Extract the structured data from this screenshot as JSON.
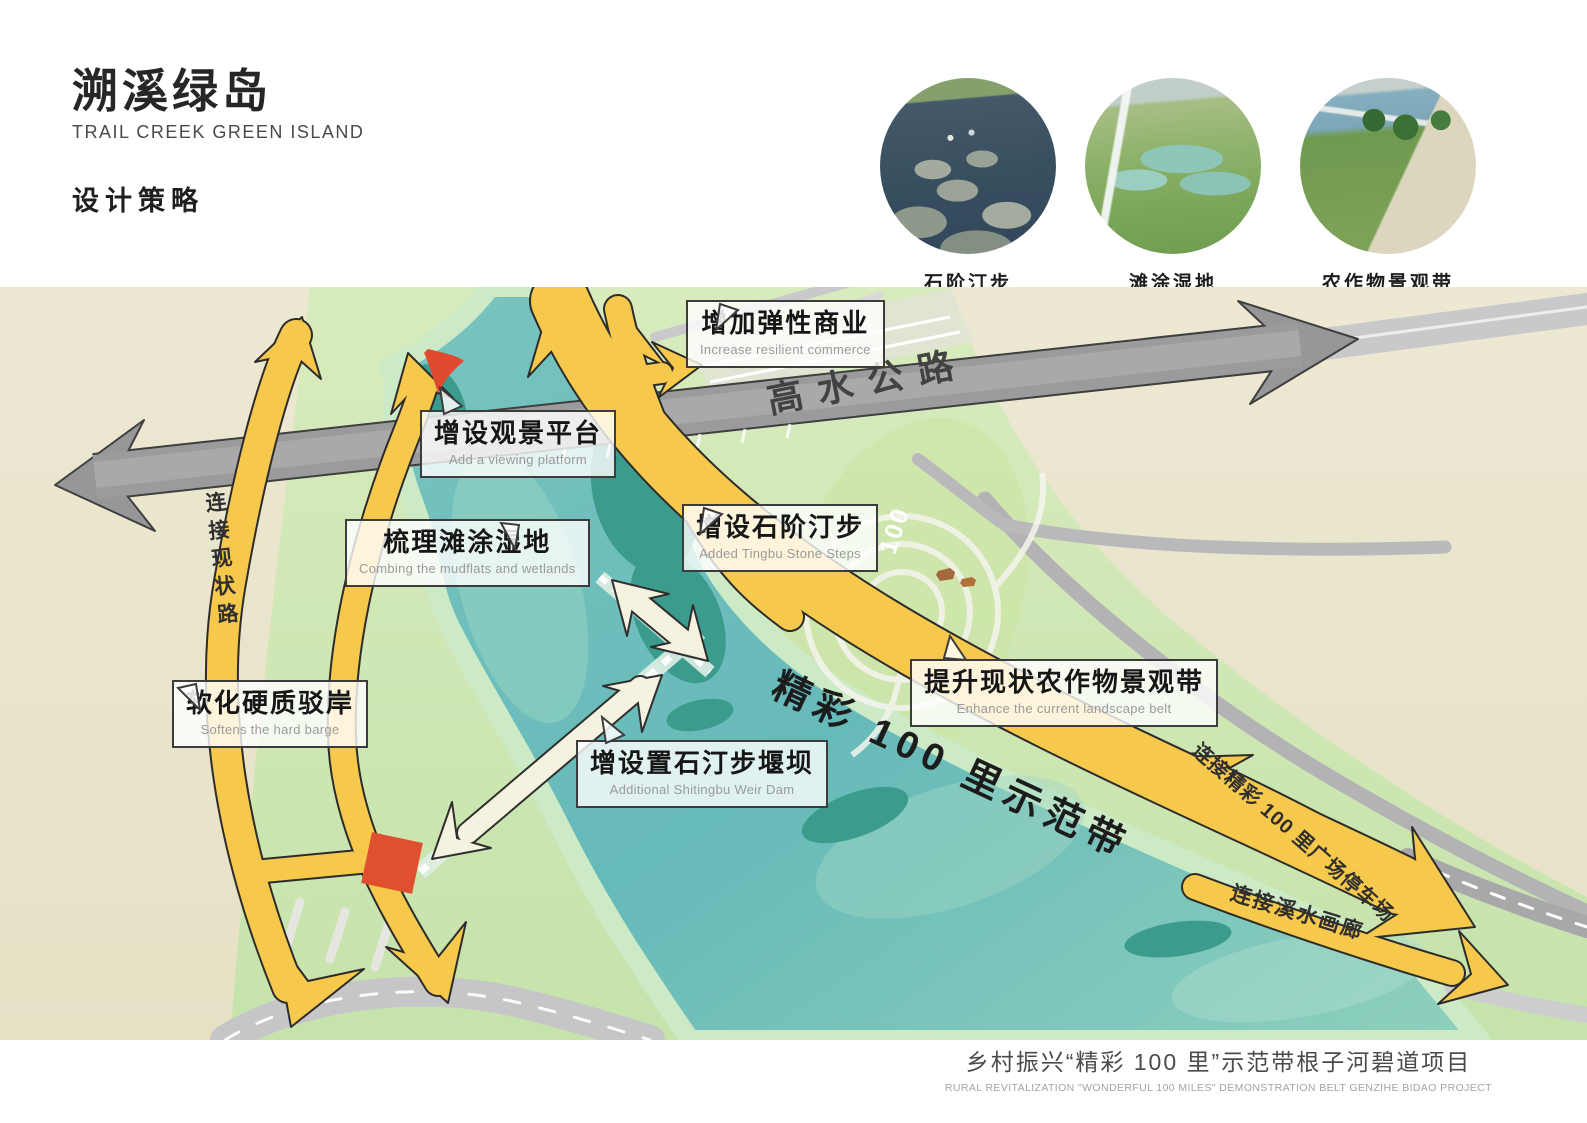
{
  "header": {
    "title_cn": "溯溪绿岛",
    "title_en": "TRAIL CREEK GREEN ISLAND",
    "section_label": "设计策略"
  },
  "reference_photos": [
    {
      "caption": "石阶汀步"
    },
    {
      "caption": "滩涂湿地"
    },
    {
      "caption": "农作物景观带"
    }
  ],
  "map": {
    "road_label": "高水公路",
    "demo_belt_label": "精彩 100 里示范带",
    "park_marker": "100",
    "arrow_labels": {
      "connect_existing_road": "连接现状路",
      "connect_parking": "连接精彩 100 里广场停车场",
      "connect_gallery": "连接溪水画廊"
    },
    "callouts": [
      {
        "cn": "增加弹性商业",
        "en": "Increase resilient commerce"
      },
      {
        "cn": "增设观景平台",
        "en": "Add a viewing platform"
      },
      {
        "cn": "梳理滩涂湿地",
        "en": "Combing the mudflats and wetlands"
      },
      {
        "cn": "增设石阶汀步",
        "en": "Added Tingbu Stone Steps"
      },
      {
        "cn": "软化硬质驳岸",
        "en": "Softens the hard barge"
      },
      {
        "cn": "增设置石汀步堰坝",
        "en": "Additional Shitingbu Weir Dam"
      },
      {
        "cn": "提升现状农作物景观带",
        "en": "Enhance the current landscape belt"
      }
    ],
    "colors": {
      "base_beige": "#e9e4ca",
      "bank_green": "#cfe7ae",
      "river_teal": "#7cc5c1",
      "island_teal": "#3b9b8c",
      "arrow_yellow": "#f6c84b",
      "road_gray": "#9b9b9e",
      "highlight_red": "#e0502f"
    }
  },
  "footer": {
    "cn": "乡村振兴“精彩 100 里”示范带根子河碧道项目",
    "en": "RURAL REVITALIZATION \"WONDERFUL 100 MILES\" DEMONSTRATION BELT GENZIHE BIDAO PROJECT"
  }
}
